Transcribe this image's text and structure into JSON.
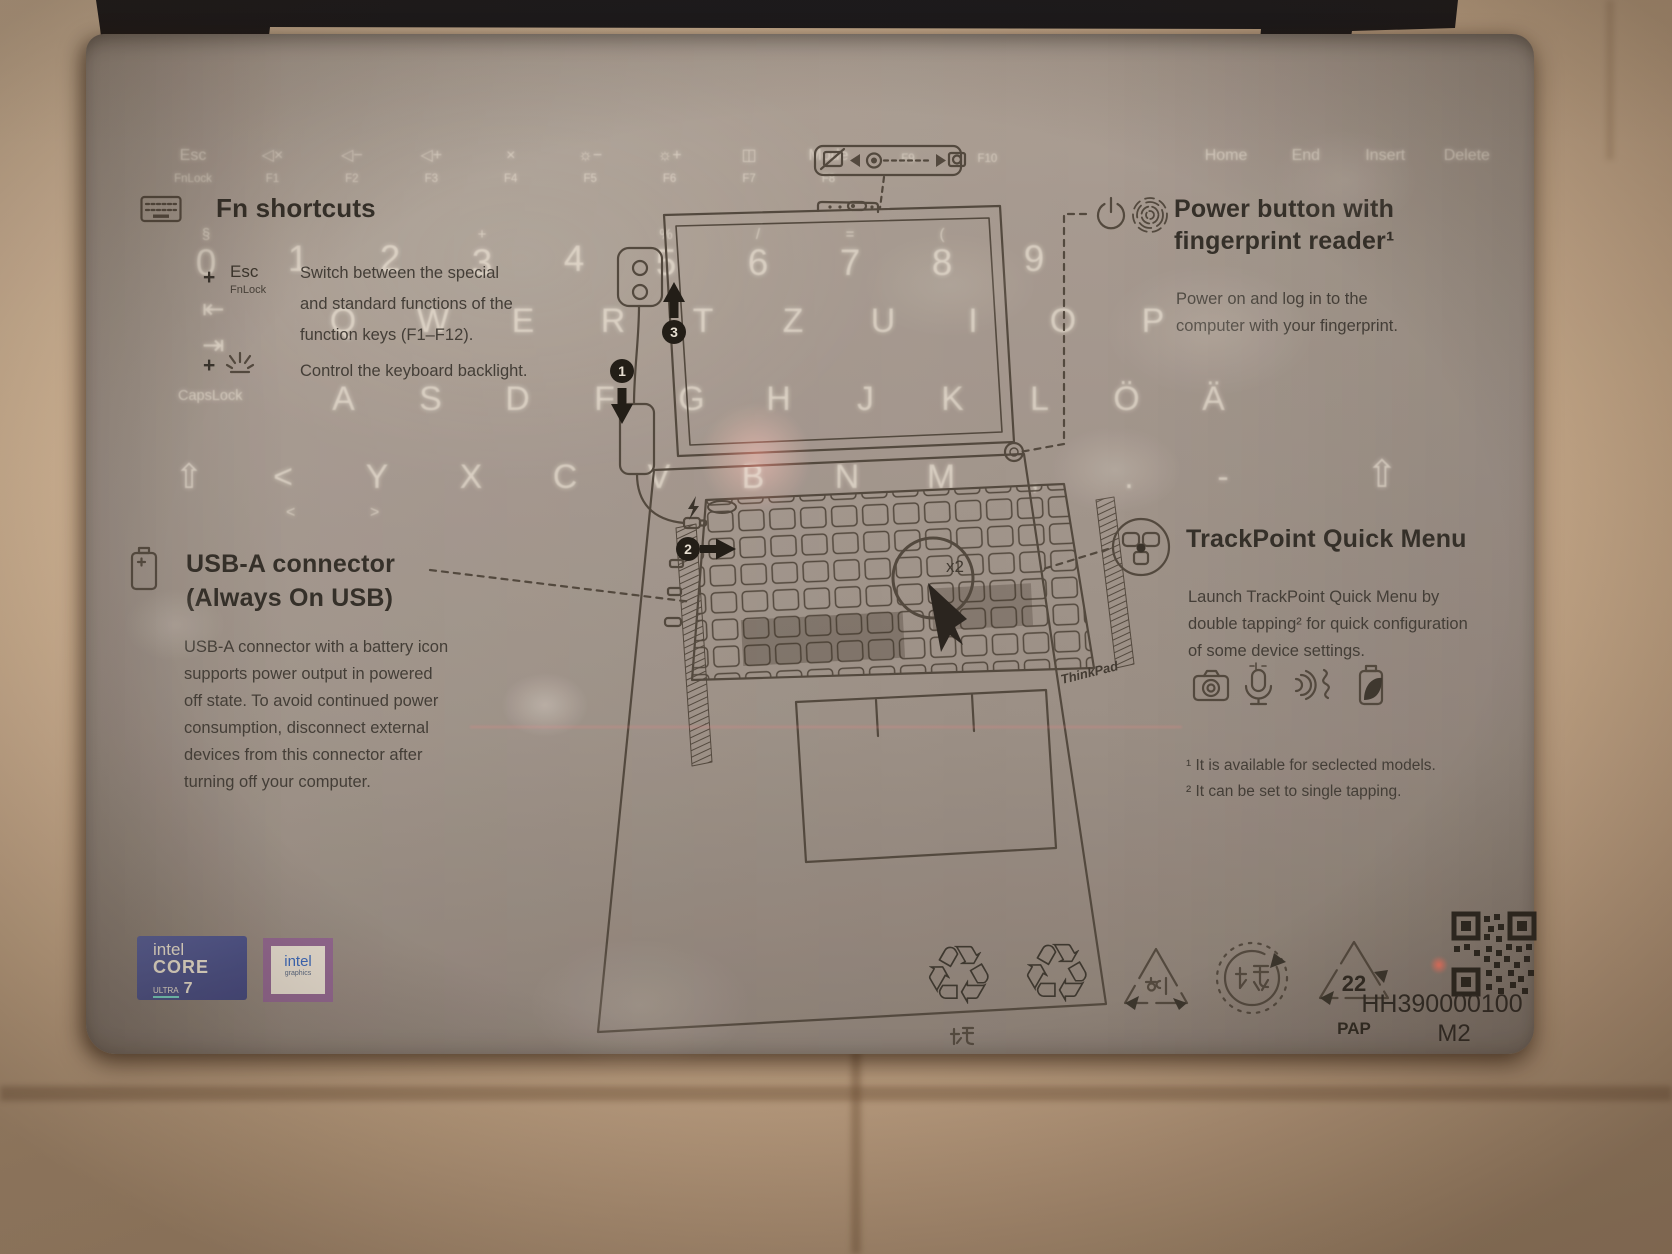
{
  "fn": {
    "title": "Fn shortcuts",
    "plus": "+",
    "item1_key": "Esc",
    "item1_sub": "FnLock",
    "item1_lines": [
      "Switch between the special",
      "and standard functions of the",
      "function keys (F1–F12)."
    ],
    "item2_text": "Control the keyboard backlight."
  },
  "power": {
    "title_line1": "Power button with",
    "title_line2": "fingerprint reader¹",
    "body_lines": [
      "Power on and log in to the",
      "computer with your fingerprint."
    ]
  },
  "usba": {
    "title_line1": "USB-A connector",
    "title_line2": "(Always On USB)",
    "body_lines": [
      "USB-A connector with a battery icon",
      "supports power output in powered",
      "off state. To avoid continued power",
      "consumption, disconnect external",
      "devices from this connector after",
      "turning off your computer."
    ]
  },
  "trackpoint": {
    "title": "TrackPoint Quick Menu",
    "body_lines": [
      "Launch TrackPoint Quick Menu by",
      "double tapping² for quick configuration",
      "of some device settings."
    ],
    "footnotes": [
      "¹ It is available for seclected models.",
      "² It can be set to single tapping."
    ]
  },
  "diagram": {
    "double_tap": "x2",
    "steps": [
      "1",
      "2",
      "3"
    ],
    "thinkpad_logo": "ThinkPad"
  },
  "ghost": {
    "capslock": "CapsLock",
    "tab_in": "⇥",
    "tab_out": "⇤",
    "shift_right": "⇧",
    "angle_lt": "<",
    "angle_gt": ">",
    "fn_row": [
      {
        "top": "Esc",
        "fkey": "FnLock"
      },
      {
        "top": "◁×",
        "fkey": "F1"
      },
      {
        "top": "◁−",
        "fkey": "F2"
      },
      {
        "top": "◁+",
        "fkey": "F3"
      },
      {
        "top": "×",
        "fkey": "F4"
      },
      {
        "top": "☼−",
        "fkey": "F5"
      },
      {
        "top": "☼+",
        "fkey": "F6"
      },
      {
        "top": "◫",
        "fkey": "F7"
      },
      {
        "top": "Mode",
        "fkey": "F8"
      },
      {
        "top": "",
        "fkey": "F9"
      },
      {
        "top": "",
        "fkey": "F10"
      },
      {
        "top": "",
        "fkey": ""
      },
      {
        "top": "",
        "fkey": ""
      },
      {
        "top": "Home",
        "fkey": ""
      },
      {
        "top": "End",
        "fkey": ""
      },
      {
        "top": "Insert",
        "fkey": ""
      },
      {
        "top": "Delete",
        "fkey": ""
      }
    ],
    "number_row": [
      {
        "t": "§",
        "n": "0"
      },
      {
        "t": "",
        "n": "1"
      },
      {
        "t": "",
        "n": "2"
      },
      {
        "t": "+",
        "n": "3"
      },
      {
        "t": "",
        "n": "4"
      },
      {
        "t": "%",
        "n": "5"
      },
      {
        "t": "/",
        "n": "6"
      },
      {
        "t": "=",
        "n": "7"
      },
      {
        "t": "(",
        "n": "8"
      },
      {
        "t": "",
        "n": "9"
      }
    ],
    "row_qwertz": [
      "Q",
      "W",
      "E",
      "R",
      "T",
      "Z",
      "U",
      "I",
      "O",
      "P"
    ],
    "row_home": [
      "A",
      "S",
      "D",
      "F",
      "G",
      "H",
      "J",
      "K",
      "L",
      "Ö",
      "Ä"
    ],
    "row_shift": [
      "⇧",
      "<",
      "Y",
      "X",
      "C",
      "V",
      "B",
      "N",
      "M",
      ",",
      ".",
      "-"
    ]
  },
  "footer": {
    "part_number": "HH390000100",
    "revision": "M2",
    "recycling": {
      "cn_caption": "纸",
      "kr_label": "종이",
      "jp_label": "紙",
      "code": "22",
      "material": "PAP"
    },
    "intel_core": {
      "brand": "intel",
      "line": "CORE",
      "tier": "ULTRA",
      "num": "7"
    },
    "intel_graphics": {
      "brand": "intel",
      "sub": "graphics"
    }
  }
}
